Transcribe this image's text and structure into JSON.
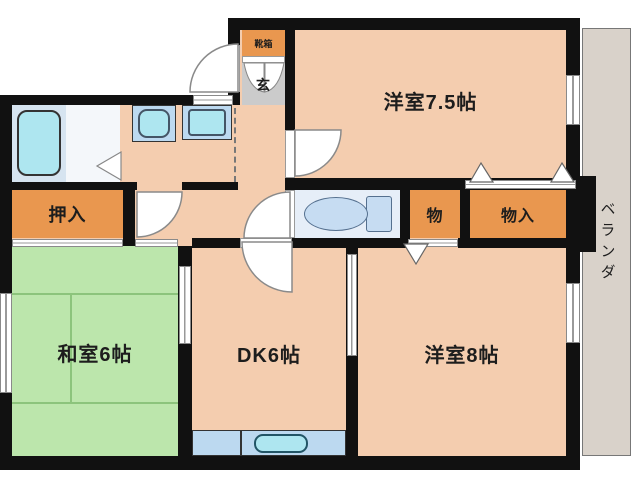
{
  "rooms": {
    "western_7_5": {
      "label": "洋室7.5帖"
    },
    "western_8": {
      "label": "洋室8帖"
    },
    "japanese_6": {
      "label": "和室6帖"
    },
    "dining_kitchen": {
      "label": "DK6帖"
    },
    "oshiire": {
      "label": "押入"
    },
    "storage_small": {
      "label": "物"
    },
    "storage_closet": {
      "label": "物入"
    },
    "genkan": {
      "label": "玄"
    },
    "shoe_cabinet": {
      "label": "靴箱"
    },
    "veranda": {
      "label": "ベランダ"
    }
  },
  "fixtures": [
    "bathtub",
    "washbasin",
    "washing-machine",
    "toilet",
    "kitchen-sink"
  ],
  "colors": {
    "wall": "#111111",
    "floor": "#f4cdaf",
    "tatami": "#bce6ac",
    "tatami_line": "#8cc47c",
    "closet": "#e9974f",
    "bath_floor": "#d6e4f0",
    "toilet_floor": "#e6eef8",
    "fixture_fill": "#bcd9f0",
    "fixture_water": "#aee6f0",
    "genkan_tile": "#cbcbcb",
    "veranda": "#d9d2ca",
    "text": "#1d1d1d"
  }
}
